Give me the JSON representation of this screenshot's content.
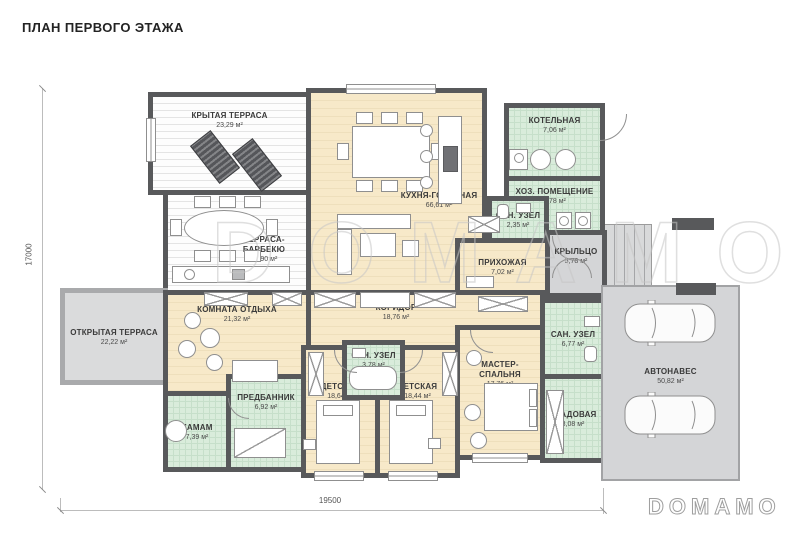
{
  "page": {
    "title": "ПЛАН ПЕРВОГО ЭТАЖА",
    "watermark": "DOMAMO",
    "logo": "DOMAMO"
  },
  "dimensions": {
    "width": "19500",
    "height": "17000"
  },
  "colors": {
    "wall": "#58595b",
    "room_living": "#f7e9c9",
    "room_wet": "#d9ecdb",
    "terrace_deck": "#fdfdfd",
    "paving": "#d4d5d7",
    "text": "#3a3a3a",
    "watermark_outline": "#c6c6c6"
  },
  "rooms": {
    "covered_terrace": {
      "name": "КРЫТАЯ ТЕРРАСА",
      "area": "23,29 м²"
    },
    "kitchen_living": {
      "name": "КУХНЯ-ГОСТИНАЯ",
      "area": "66,61 м²"
    },
    "bbq_terrace": {
      "name": "ТЕРРАСА-БАРБЕКЮ",
      "area": "27,90 м²"
    },
    "boiler": {
      "name": "КОТЕЛЬНАЯ",
      "area": "7,06 м²"
    },
    "utility": {
      "name": "ХОЗ. ПОМЕЩЕНИЕ",
      "area": "6,78 м²"
    },
    "wc_small": {
      "name": "САН. УЗЕЛ",
      "area": "2,35 м²"
    },
    "hallway": {
      "name": "ПРИХОЖАЯ",
      "area": "7,02 м²"
    },
    "porch": {
      "name": "КРЫЛЬЦО",
      "area": "5,78 м²"
    },
    "open_terrace": {
      "name": "ОТКРЫТАЯ ТЕРРАСА",
      "area": "22,22 м²"
    },
    "lounge": {
      "name": "КОМНАТА ОТДЫХА",
      "area": "21,32 м²"
    },
    "corridor": {
      "name": "КОРИДОР",
      "area": "18,76 м²"
    },
    "hamam": {
      "name": "ХАМАМ",
      "area": "7,39 м²"
    },
    "vestibule": {
      "name": "ПРЕДБАННИК",
      "area": "6,92 м²"
    },
    "kids1": {
      "name": "ДЕТСКАЯ",
      "area": "18,64 м²"
    },
    "wc_kids": {
      "name": "САН. УЗЕЛ",
      "area": "3,78 м²"
    },
    "kids2": {
      "name": "ДЕТСКАЯ",
      "area": "18,44 м²"
    },
    "master": {
      "name": "МАСТЕР-СПАЛЬНЯ",
      "area": "17,76 м²"
    },
    "wc_master": {
      "name": "САН. УЗЕЛ",
      "area": "6,77 м²"
    },
    "storage": {
      "name": "КЛАДОВАЯ",
      "area": "8,08 м²"
    },
    "carport": {
      "name": "АВТОНАВЕС",
      "area": "50,82 м²"
    }
  }
}
